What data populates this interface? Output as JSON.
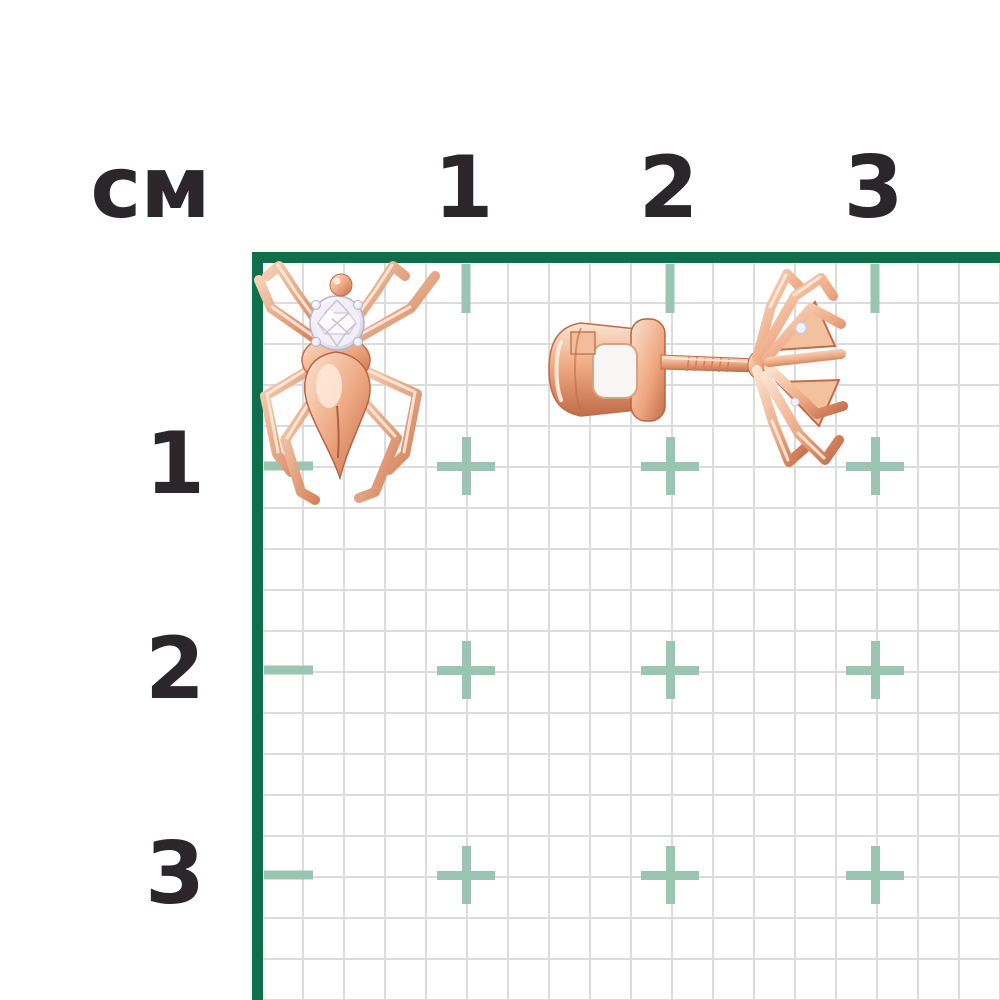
{
  "ruler": {
    "unit_label": "см",
    "top_labels": [
      "1",
      "2",
      "3"
    ],
    "left_labels": [
      "1",
      "2",
      "3"
    ],
    "cm_positions_px": [
      466,
      670,
      875
    ],
    "cell_px": 41,
    "label_color": "#2a2629",
    "border_color": "#0f6f4d",
    "grid_line_color": "#dcdcdc",
    "tick_cross_color": "#9ac5b3"
  },
  "product": {
    "front_view_name": "spider-stud-earring-front",
    "side_view_name": "spider-stud-earring-side-with-screw-back",
    "colors": {
      "rose_gold_light": "#fbe3d0",
      "rose_gold_mid": "#eda57e",
      "rose_gold_dark": "#c06c49",
      "diamond_white": "#f2f0f6",
      "silver_setting": "#d8d4e3"
    }
  }
}
